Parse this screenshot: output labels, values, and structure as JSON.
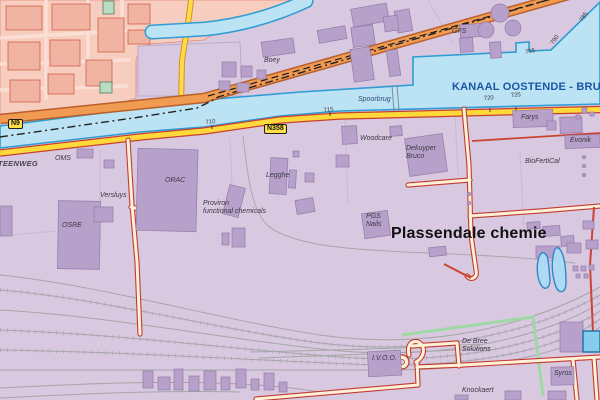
{
  "map": {
    "canal_name": "KANAAL OOSTENDE - BRUGGE",
    "region_title": "Plassendale chemie",
    "badges": {
      "n9": "N9",
      "n358": "N358"
    },
    "place_labels": [
      {
        "id": "boey",
        "text": "Boey",
        "x": 264,
        "y": 57,
        "cls": "lbl"
      },
      {
        "id": "gfs",
        "text": "GFS",
        "x": 452,
        "y": 28,
        "cls": "lbl"
      },
      {
        "id": "spoorbrug",
        "text": "Spoorbrug",
        "x": 358,
        "y": 96,
        "cls": "lbl-blue"
      },
      {
        "id": "steenweg",
        "text": "TEENWEG",
        "x": -2,
        "y": 160,
        "cls": "street"
      },
      {
        "id": "oms",
        "text": "OMS",
        "x": 55,
        "y": 155,
        "cls": "lbl"
      },
      {
        "id": "orac",
        "text": "ORAC",
        "x": 165,
        "y": 177,
        "cls": "lbl"
      },
      {
        "id": "versluys",
        "text": "Versluys",
        "x": 100,
        "y": 192,
        "cls": "lbl"
      },
      {
        "id": "osre",
        "text": "OSRE",
        "x": 62,
        "y": 222,
        "cls": "lbl"
      },
      {
        "id": "legghe",
        "text": "Legghe",
        "x": 266,
        "y": 172,
        "cls": "lbl"
      },
      {
        "id": "woodcare",
        "text": "Woodcare",
        "x": 360,
        "y": 135,
        "cls": "lbl"
      },
      {
        "id": "proviron",
        "text": "Proviron\nfunctional chemicals",
        "x": 203,
        "y": 200,
        "cls": "lbl"
      },
      {
        "id": "pgs-nails",
        "text": "PGS\nNails",
        "x": 366,
        "y": 213,
        "cls": "lbl"
      },
      {
        "id": "dekuyper",
        "text": "Dekuyper\nBruco",
        "x": 406,
        "y": 145,
        "cls": "lbl"
      },
      {
        "id": "farys",
        "text": "Farys",
        "x": 521,
        "y": 114,
        "cls": "lbl"
      },
      {
        "id": "evonik",
        "text": "Evonik",
        "x": 570,
        "y": 137,
        "cls": "lbl"
      },
      {
        "id": "biofertical",
        "text": "BioFertiCal",
        "x": 525,
        "y": 158,
        "cls": "lbl"
      },
      {
        "id": "plassendale",
        "text": "Plassendale chemie",
        "x": 391,
        "y": 225,
        "cls": "region-title"
      },
      {
        "id": "ivoo",
        "text": "I.V.O.O.",
        "x": 372,
        "y": 355,
        "cls": "lbl"
      },
      {
        "id": "debree",
        "text": "De Bree\nSolutions",
        "x": 462,
        "y": 338,
        "cls": "lbl"
      },
      {
        "id": "knockaert",
        "text": "Knockaert",
        "x": 462,
        "y": 387,
        "cls": "lbl"
      },
      {
        "id": "syros",
        "text": "Syros",
        "x": 554,
        "y": 370,
        "cls": "lbl"
      }
    ],
    "hectometer_marks": [
      {
        "text": "710",
        "x": 206,
        "y": 120,
        "rot": -6
      },
      {
        "text": "715",
        "x": 324,
        "y": 108,
        "rot": -6
      },
      {
        "text": "720",
        "x": 484,
        "y": 96,
        "rot": -4
      },
      {
        "text": "725",
        "x": 511,
        "y": 93,
        "rot": -4
      },
      {
        "text": "795",
        "x": 526,
        "y": 50,
        "rot": -12
      },
      {
        "text": "790",
        "x": 555,
        "y": 40,
        "rot": -56
      },
      {
        "text": "785",
        "x": 584,
        "y": 17,
        "rot": -56
      }
    ],
    "colors": {
      "industrial_bg": "#d8c8e0",
      "urban_bg": "#f7cdbf",
      "building_purple": "#b7a1ca",
      "canal_fill": "#bce3f3",
      "canal_border": "#2f9cd4",
      "road_yellow": "#ffd93b",
      "road_casing_red": "#c8402e",
      "road_orange": "#f09a52",
      "cream_road": "#fdf2d8",
      "canal_label_blue": "#1956a8",
      "railway_gray": "#a6a6a6",
      "green_boundary": "#9ed8a4"
    }
  }
}
